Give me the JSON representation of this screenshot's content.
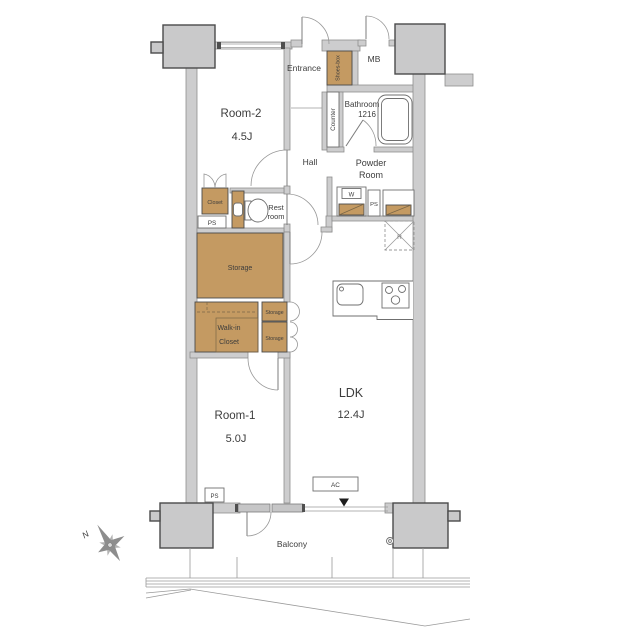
{
  "labels": {
    "entrance": "Entrance",
    "shoes_box": "Shoes-box",
    "mb": "MB",
    "bathroom_line1": "Bathroom",
    "bathroom_line2": "1216",
    "counter": "Counter",
    "hall": "Hall",
    "powder_line1": "Powder",
    "powder_line2": "Room",
    "room2_name": "Room-2",
    "room2_size": "4.5J",
    "closet": "Closet",
    "ps": "PS",
    "rest_line1": "Rest",
    "rest_line2": "room",
    "storage": "Storage",
    "walkin_line1": "Walk-in",
    "walkin_line2": "Closet",
    "washer": "W",
    "fridge": "R",
    "room1_name": "Room-1",
    "room1_size": "5.0J",
    "ldk_name": "LDK",
    "ldk_size": "12.4J",
    "ac": "AC",
    "balcony": "Balcony",
    "compass_north": "N"
  },
  "colors": {
    "wood_accent": "#c49a62",
    "wall_gray": "#cdcdce",
    "pillar_gray": "#c9c9ca",
    "text": "#3c3c3c"
  }
}
